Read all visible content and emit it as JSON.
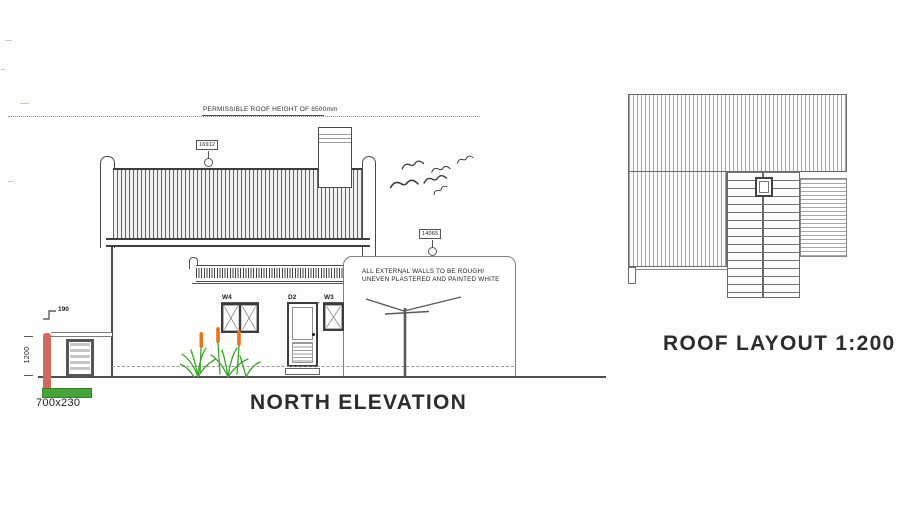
{
  "titles": {
    "elevation": "NORTH ELEVATION",
    "roof_layout": "ROOF LAYOUT 1:200"
  },
  "annotations": {
    "permissible_roof_height": "PERMISSIBLE ROOF HEIGHT OF 8500mm",
    "wall_finish_line1": "ALL EXTERNAL WALLS TO BE ROUGH/",
    "wall_finish_line2": "UNEVEN PLASTERED AND PAINTED WHITE"
  },
  "level_markers": {
    "roof_ridge": "16912",
    "extension_roof": "14065"
  },
  "openings": {
    "window_left": "W4",
    "door": "D2",
    "window_right": "W3"
  },
  "boundary_wall": {
    "coping_height": "190",
    "wall_height": "1200",
    "foundation_size": "700x230"
  },
  "colors": {
    "wall_section_red": "#d4685e",
    "foundation_green": "#48a33b",
    "foliage_green": "#3aa32a",
    "flower_orange": "#e8731f",
    "linework": "#4a4a4a"
  }
}
